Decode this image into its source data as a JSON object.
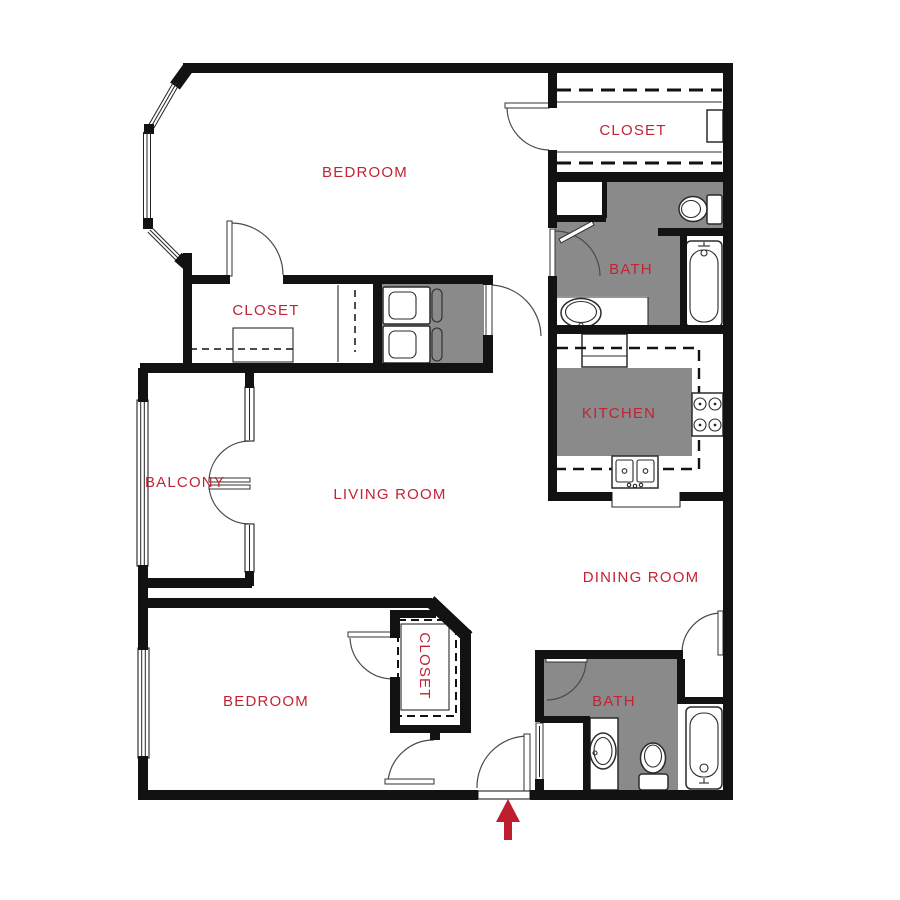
{
  "plan": {
    "type": "apartment-floor-plan",
    "entry_marker": "red arrow pointing up at main entry door",
    "rooms": [
      "BEDROOM",
      "CLOSET",
      "CLOSET",
      "BATH",
      "KITCHEN",
      "BALCONY",
      "LIVING ROOM",
      "DINING ROOM",
      "BEDROOM",
      "CLOSET",
      "BATH"
    ]
  },
  "labels": {
    "bedroom_top": "BEDROOM",
    "closet_top": "CLOSET",
    "walkin_closet": "CLOSET",
    "bath_top": "BATH",
    "kitchen": "KITCHEN",
    "balcony": "BALCONY",
    "living_room": "LIVING ROOM",
    "dining_room": "DINING ROOM",
    "bedroom_lower": "BEDROOM",
    "closet_lower": "CLOSET",
    "bath_lower": "BATH"
  },
  "colors": {
    "label": "#c22335",
    "wall": "#121212",
    "room_fill": "#8a8a8a",
    "arrow": "#be1e2d",
    "background": "#ffffff"
  },
  "fixtures": [
    "bay-window",
    "washer-dryer",
    "refrigerator",
    "stove",
    "kitchen-double-sink",
    "kitchen-island",
    "bathtub-upper",
    "toilet-upper",
    "vanity-sink-upper",
    "linen-closet",
    "bathtub-lower",
    "toilet-lower",
    "vanity-sink-lower",
    "french-balcony-doors",
    "entry-arrow"
  ]
}
